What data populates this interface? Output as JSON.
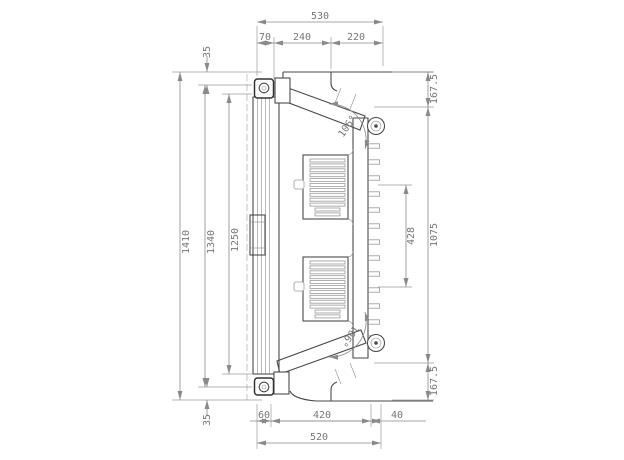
{
  "drawing": {
    "type": "technical-cross-section",
    "subject": "hinged panel / heater door section view",
    "units": "mm",
    "dims": {
      "top_total": "530",
      "top_seg1": "70",
      "top_seg2": "240",
      "top_seg3": "220",
      "offset_top": "35",
      "offset_bottom": "35",
      "height_outer": "1410",
      "height_frame": "1340",
      "height_door": "1250",
      "right_top": "167.5",
      "right_middle": "1075",
      "right_bottom": "167.5",
      "element_gap": "428",
      "angle_top": "106°",
      "angle_bottom": "106°",
      "bottom_seg1": "60",
      "bottom_seg2": "420",
      "bottom_seg3": "40",
      "bottom_total": "520"
    },
    "colors": {
      "background": "#ffffff",
      "part_line": "#4a4a4a",
      "dimension_line": "#8a8a8a",
      "label_text": "#767676",
      "hatch": "#909090"
    }
  }
}
